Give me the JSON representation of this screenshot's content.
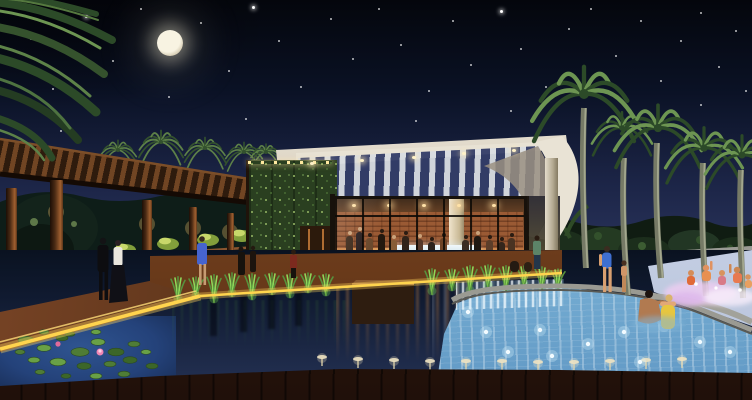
{
  "scene": {
    "name": "night-resort-clubhouse-pool-architectural-rendering",
    "palette": {
      "skyTop": "#04060c",
      "skyMid": "#1c2547",
      "skyHorizon": "#555e8e",
      "moon": "#f4eeda",
      "star": "#ffffff",
      "palmDark": "#2c4a28",
      "palmLit": "#6d9552",
      "trunk": "#767a66",
      "trunkLit": "#a3a78e",
      "wood": "#6b3f20",
      "woodDark": "#2e1b0d",
      "woodLit": "#b87a40",
      "sconce": "#ffd88a",
      "led": "#ffd44e",
      "greenWall": "#2a3f20",
      "greenWallLit": "#7c9a54",
      "roofWhite": "#efe9dc",
      "roofShadow": "#9b9181",
      "interiorWarm": "#c8824a",
      "brick": "#9a5a34",
      "counter": "#e8f2f6",
      "glassFrame": "#17110b",
      "pondDark": "#0c1424",
      "grass": "#57923d",
      "grassLit": "#8fd75a",
      "lily": "#4f7c36",
      "lilyFlower": "#ef86b4",
      "pool": "#7fb6d8",
      "poolLight": "#d6ecf4",
      "coping": "#9a9a92",
      "stone": "#8c8c86",
      "deck": "#4a2a16",
      "splash": "#eed6f0",
      "skin": "#d89f70",
      "treeline": "#101c12"
    },
    "sky": {
      "stars": [
        [
          30,
          38,
          1
        ],
        [
          52,
          88,
          1
        ],
        [
          85,
          15,
          2
        ],
        [
          112,
          60,
          1
        ],
        [
          140,
          8,
          1
        ],
        [
          168,
          96,
          1
        ],
        [
          200,
          22,
          1
        ],
        [
          228,
          70,
          1
        ],
        [
          252,
          6,
          2
        ],
        [
          278,
          40,
          1
        ],
        [
          300,
          86,
          1
        ],
        [
          330,
          18,
          1
        ],
        [
          352,
          58,
          1
        ],
        [
          378,
          8,
          1
        ],
        [
          400,
          44,
          1
        ],
        [
          428,
          90,
          1
        ],
        [
          452,
          20,
          1
        ],
        [
          470,
          64,
          1
        ],
        [
          500,
          10,
          2
        ],
        [
          520,
          48,
          1
        ],
        [
          545,
          86,
          1
        ],
        [
          568,
          28,
          1
        ],
        [
          590,
          8,
          1
        ],
        [
          615,
          55,
          1
        ],
        [
          640,
          20,
          1
        ],
        [
          660,
          80,
          1
        ],
        [
          680,
          40,
          1
        ],
        [
          700,
          12,
          1
        ],
        [
          718,
          66,
          1
        ],
        [
          735,
          30,
          1
        ],
        [
          745,
          90,
          1
        ],
        [
          60,
          130,
          1
        ],
        [
          245,
          118,
          1
        ],
        [
          510,
          110,
          1
        ],
        [
          700,
          104,
          1
        ],
        [
          415,
          120,
          1
        ]
      ],
      "moon": {
        "x": 157,
        "y": 30,
        "d": 26
      }
    },
    "royalPalms": [
      {
        "cx": 584,
        "cy": 94,
        "size": 62,
        "trunk": "M584,108 C582,160 583,215 586,268"
      },
      {
        "cx": 622,
        "cy": 128,
        "size": 36,
        "trunk": "M624,158 C622,200 624,250 628,295"
      },
      {
        "cx": 658,
        "cy": 128,
        "size": 52,
        "trunk": "M657,143 C655,190 657,235 661,278"
      },
      {
        "cx": 704,
        "cy": 148,
        "size": 46,
        "trunk": "M703,163 C701,210 703,255 706,296"
      },
      {
        "cx": 742,
        "cy": 155,
        "size": 44,
        "trunk": "M741,170 C739,215 741,255 743,298"
      }
    ],
    "datePalms": [
      [
        118,
        150,
        22
      ],
      [
        161,
        142,
        26
      ],
      [
        205,
        148,
        24
      ],
      [
        244,
        152,
        22
      ],
      [
        266,
        152,
        18
      ]
    ],
    "pergola": {
      "columns": [
        [
          6,
          188,
          11,
          142
        ],
        [
          50,
          180,
          13,
          142
        ],
        [
          142,
          200,
          10,
          106
        ],
        [
          189,
          207,
          8,
          85
        ],
        [
          227,
          213,
          7,
          69
        ],
        [
          252,
          217,
          6,
          59
        ]
      ],
      "sconces": [
        [
          56,
          212
        ],
        [
          147,
          224
        ],
        [
          193,
          228
        ],
        [
          230,
          232
        ],
        [
          255,
          234
        ]
      ],
      "shrubs": [
        [
          125,
          250
        ],
        [
          168,
          244
        ],
        [
          208,
          240
        ],
        [
          242,
          236
        ]
      ]
    },
    "crowd": [
      {
        "x": 14,
        "h": 30,
        "c": "#3d2a1b"
      },
      {
        "x": 24,
        "h": 34,
        "c": "#2a2020"
      },
      {
        "x": 34,
        "h": 28,
        "c": "#6b4a2e"
      },
      {
        "x": 46,
        "h": 32,
        "c": "#23180f"
      },
      {
        "x": 58,
        "h": 26,
        "c": "#875d36"
      },
      {
        "x": 70,
        "h": 30,
        "c": "#31241a"
      },
      {
        "x": 84,
        "h": 27,
        "c": "#55382a"
      },
      {
        "x": 96,
        "h": 24,
        "c": "#2c221c"
      },
      {
        "x": 108,
        "h": 28,
        "c": "#6e4326"
      },
      {
        "x": 130,
        "h": 26,
        "c": "#3a2c22"
      },
      {
        "x": 142,
        "h": 30,
        "c": "#1f1812"
      },
      {
        "x": 154,
        "h": 26,
        "c": "#5c3e2a"
      },
      {
        "x": 166,
        "h": 24,
        "c": "#33261c"
      },
      {
        "x": 176,
        "h": 28,
        "c": "#4a3322"
      }
    ],
    "ceilingLights": [
      20,
      55,
      90,
      125,
      160
    ],
    "downlights": [
      [
        310,
        162
      ],
      [
        360,
        159
      ],
      [
        412,
        156
      ],
      [
        462,
        152
      ],
      [
        512,
        149
      ]
    ],
    "grassTufts": [
      [
        178,
        302,
        24
      ],
      [
        196,
        298,
        20
      ],
      [
        214,
        302,
        26
      ],
      [
        232,
        296,
        22
      ],
      [
        252,
        299,
        24
      ],
      [
        272,
        294,
        20
      ],
      [
        290,
        297,
        22
      ],
      [
        308,
        292,
        18
      ],
      [
        326,
        295,
        20
      ],
      [
        432,
        294,
        24
      ],
      [
        452,
        290,
        20
      ],
      [
        470,
        293,
        26
      ],
      [
        488,
        288,
        22
      ],
      [
        506,
        291,
        24
      ],
      [
        524,
        287,
        20
      ],
      [
        542,
        290,
        22
      ],
      [
        558,
        288,
        18
      ]
    ],
    "lilies": [
      [
        26,
        340,
        16
      ],
      [
        44,
        348,
        14
      ],
      [
        62,
        338,
        12
      ],
      [
        80,
        352,
        18
      ],
      [
        98,
        342,
        14
      ],
      [
        116,
        352,
        16
      ],
      [
        134,
        344,
        12
      ],
      [
        58,
        362,
        16
      ],
      [
        84,
        366,
        14
      ],
      [
        110,
        364,
        12
      ],
      [
        34,
        360,
        12
      ],
      [
        130,
        360,
        14
      ],
      [
        20,
        352,
        10
      ],
      [
        146,
        352,
        10
      ],
      [
        70,
        334,
        10
      ],
      [
        44,
        332,
        10
      ],
      [
        96,
        332,
        10
      ],
      [
        152,
        366,
        12
      ],
      [
        124,
        374,
        12
      ],
      [
        96,
        376,
        12
      ],
      [
        66,
        376,
        10
      ],
      [
        40,
        372,
        10
      ]
    ],
    "jets": [
      [
        322,
        366
      ],
      [
        358,
        368
      ],
      [
        394,
        369
      ],
      [
        430,
        370
      ],
      [
        466,
        370
      ],
      [
        502,
        370
      ],
      [
        538,
        371
      ],
      [
        574,
        371
      ],
      [
        610,
        370
      ],
      [
        646,
        369
      ],
      [
        682,
        368
      ]
    ],
    "poolLights": [
      [
        468,
        312
      ],
      [
        486,
        332
      ],
      [
        508,
        352
      ],
      [
        552,
        356
      ],
      [
        588,
        344
      ],
      [
        624,
        332
      ],
      [
        664,
        326
      ],
      [
        700,
        342
      ],
      [
        730,
        352
      ],
      [
        640,
        362
      ],
      [
        540,
        330
      ]
    ],
    "reflCols": [
      [
        210,
        282,
        54
      ],
      [
        240,
        282,
        50
      ],
      [
        268,
        283,
        46
      ],
      [
        295,
        284,
        42
      ]
    ],
    "people": [
      {
        "id": "man-black-suit",
        "where": "left-walkway"
      },
      {
        "id": "woman-white-top-black-skirt",
        "where": "left-walkway"
      },
      {
        "id": "woman-blue-dress",
        "where": "left-walkway"
      },
      {
        "id": "two-guests",
        "where": "front-walkway"
      },
      {
        "id": "guest-red",
        "where": "front-walkway"
      },
      {
        "id": "man-green-shirt",
        "where": "rock-garden"
      },
      {
        "id": "sitting-pair",
        "where": "pool-edge"
      },
      {
        "id": "woman-blue-swimsuit",
        "where": "pool-deck"
      },
      {
        "id": "child",
        "where": "pool-deck"
      },
      {
        "id": "man-in-pool",
        "where": "main-pool"
      },
      {
        "id": "woman-yellow-swimsuit",
        "where": "main-pool"
      },
      {
        "id": "splashing-kids",
        "where": "kids-pool"
      }
    ]
  }
}
